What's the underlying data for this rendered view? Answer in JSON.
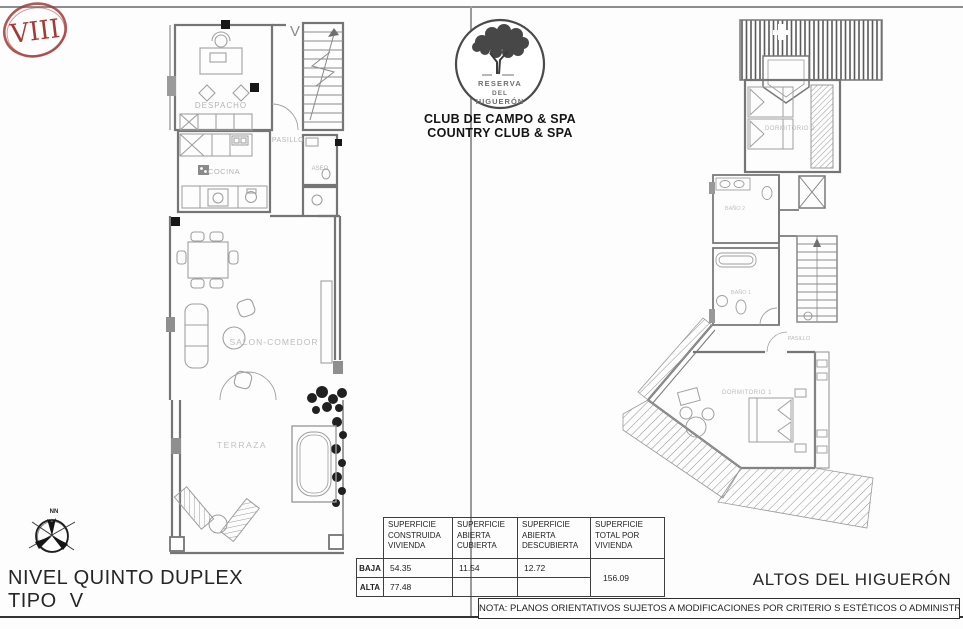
{
  "stamp": {
    "numeral": "VIII"
  },
  "logo": {
    "circle_line1": "RESERVA",
    "circle_line2": "DEL",
    "circle_line3": "HIGUERÓN",
    "subtitle_line1": "CLUB DE CAMPO & SPA",
    "subtitle_line2": "COUNTRY CLUB & SPA"
  },
  "left_plan": {
    "floor_mark": "V",
    "rooms": {
      "despacho": "DESPACHO",
      "pasillo": "PASILLO",
      "cocina": "COCINA",
      "aseo": "ASEO",
      "salon_comedor": "SALON-COMEDOR",
      "terraza": "TERRAZA"
    }
  },
  "right_plan": {
    "rooms": {
      "dormitorio2": "DORMITORIO 2",
      "bano2": "BAÑO 2",
      "bano1": "BAÑO 1",
      "pasillo": "PASILLO",
      "dormitorio1": "DORMITORIO 1"
    }
  },
  "compass": {
    "label": "NN"
  },
  "areas_table": {
    "col_headers": [
      "SUPERFICIE CONSTRUIDA VIVIENDA",
      "SUPERFICIE ABIERTA CUBIERTA",
      "SUPERFICIE ABIERTA DESCUBIERTA",
      "SUPERFICIE TOTAL POR VIVIENDA"
    ],
    "rows": [
      {
        "label": "BAJA",
        "construida": "54.35",
        "cubierta": "11.54",
        "descubierta": "12.72"
      },
      {
        "label": "ALTA",
        "construida": "77.48",
        "cubierta": "",
        "descubierta": ""
      }
    ],
    "total": "156.09"
  },
  "titles": {
    "level_line1": "NIVEL QUINTO DUPLEX",
    "level_line2": "TIPO V",
    "development_name": "ALTOS DEL HIGUERÓN"
  },
  "note": "NOTA: PLANOS ORIENTATIVOS SUJETOS A MODIFICACIONES POR CRITERIO S ESTÉTICOS O ADMINISTRATIVOS",
  "colors": {
    "stamp_red": "#a33a36",
    "line_grey": "#8a8a8a",
    "ink": "#1c1c1c"
  }
}
